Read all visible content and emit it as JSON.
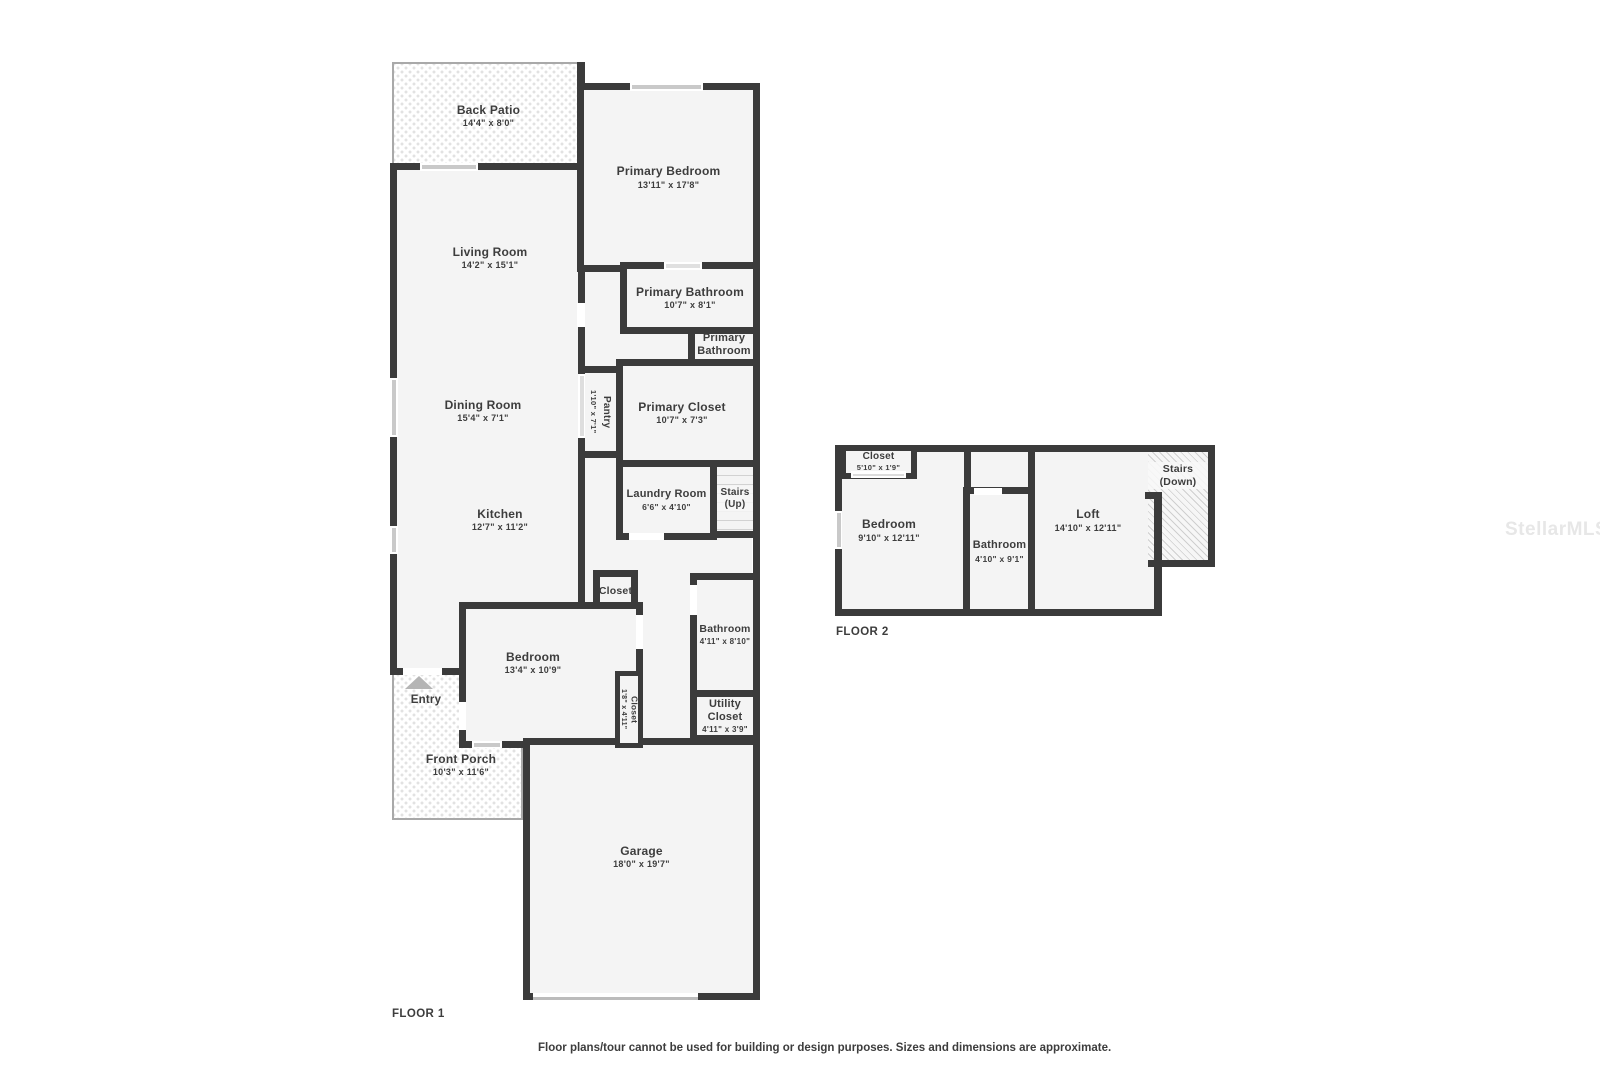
{
  "watermark": "StellarMLS",
  "footer": {
    "disclaimer": "Floor plans/tour cannot be used for building or design purposes. Sizes and dimensions are approximate."
  },
  "colors": {
    "wall": "#3b3b3b",
    "room_fill": "#f4f4f4",
    "text": "#3d3d3d",
    "window_bar": "#c9c9c9",
    "outdoor_border": "#a9a9a9"
  },
  "floor1": {
    "label": "FLOOR 1",
    "rooms": {
      "back_patio": {
        "name": "Back Patio",
        "dims": "14'4\" x 8'0\""
      },
      "living_room": {
        "name": "Living Room",
        "dims": "14'2\" x 15'1\""
      },
      "dining_room": {
        "name": "Dining Room",
        "dims": "15'4\" x 7'1\""
      },
      "kitchen": {
        "name": "Kitchen",
        "dims": "12'7\" x 11'2\""
      },
      "primary_bedroom": {
        "name": "Primary Bedroom",
        "dims": "13'11\" x 17'8\""
      },
      "primary_bathroom": {
        "name": "Primary Bathroom",
        "dims": "10'7\" x 8'1\""
      },
      "primary_bathroom_2": {
        "name": "Primary Bathroom",
        "dims": "5'0\" x 3'0\""
      },
      "pantry": {
        "name": "Pantry",
        "dims": "1'10\" x 7'1\""
      },
      "primary_closet": {
        "name": "Primary Closet",
        "dims": "10'7\" x 7'3\""
      },
      "laundry_room": {
        "name": "Laundry Room",
        "dims": "6'6\" x 4'10\""
      },
      "stairs_up": {
        "name": "Stairs (Up)"
      },
      "closet_hall": {
        "name": "Closet"
      },
      "bedroom": {
        "name": "Bedroom",
        "dims": "13'4\" x 10'9\""
      },
      "closet_bedroom": {
        "name": "Closet",
        "dims": "1'8\" x 4'11\""
      },
      "bathroom": {
        "name": "Bathroom",
        "dims": "4'11\" x 8'10\""
      },
      "utility_closet": {
        "name": "Utility Closet",
        "dims": "4'11\" x 3'9\""
      },
      "entry": {
        "name": "Entry"
      },
      "front_porch": {
        "name": "Front Porch",
        "dims": "10'3\" x 11'6\""
      },
      "garage": {
        "name": "Garage",
        "dims": "18'0\" x 19'7\""
      }
    }
  },
  "floor2": {
    "label": "FLOOR 2",
    "rooms": {
      "closet": {
        "name": "Closet",
        "dims": "5'10\" x 1'9\""
      },
      "bedroom": {
        "name": "Bedroom",
        "dims": "9'10\" x 12'11\""
      },
      "bathroom": {
        "name": "Bathroom",
        "dims": "4'10\" x 9'1\""
      },
      "loft": {
        "name": "Loft",
        "dims": "14'10\" x 12'11\""
      },
      "stairs_down": {
        "name": "Stairs (Down)"
      }
    }
  }
}
